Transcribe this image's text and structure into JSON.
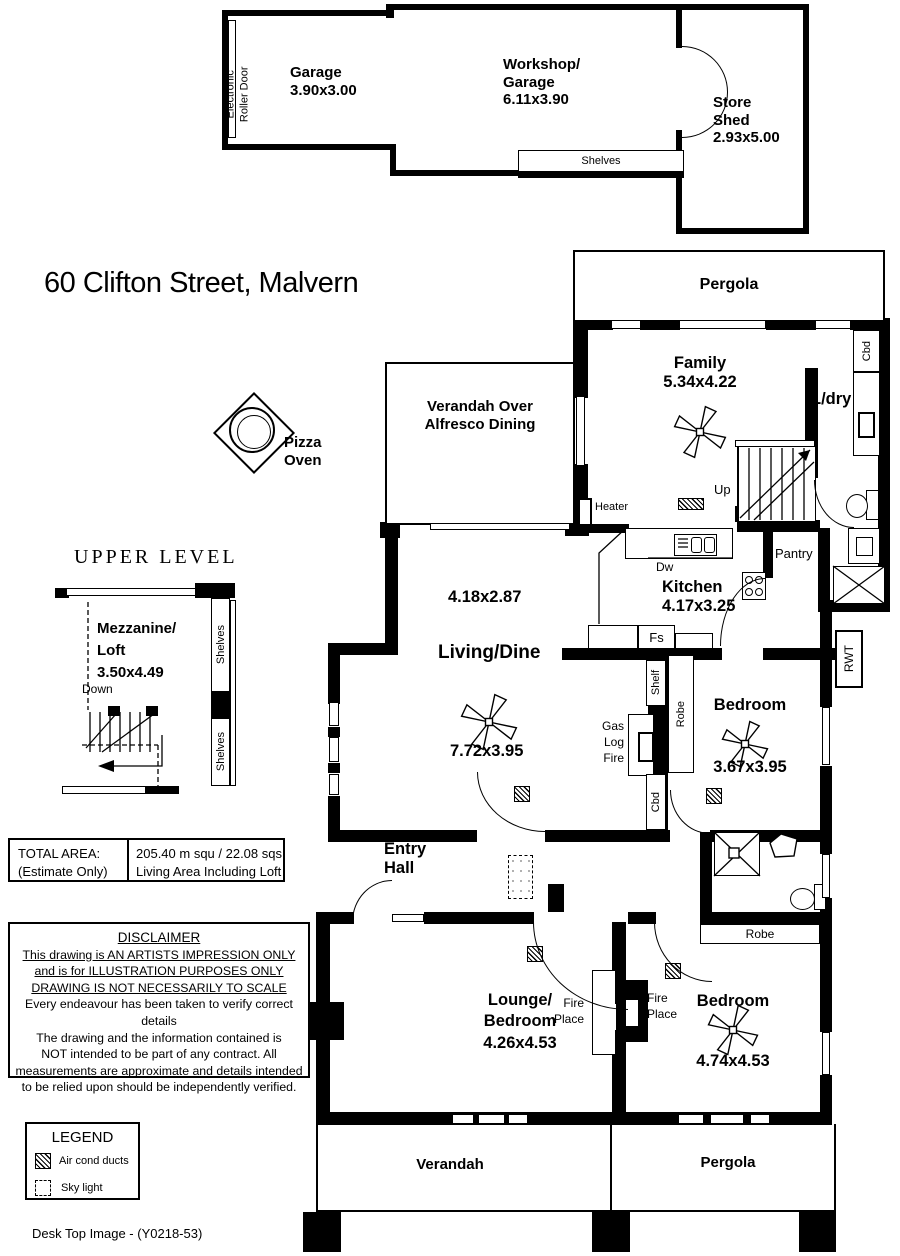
{
  "title": "60 Clifton Street, Malvern",
  "footer": "Desk Top Image - (Y0218-53)",
  "outbuilding": {
    "roller_1": "Electronic",
    "roller_2": "Roller Door",
    "garage_name": "Garage",
    "garage_dims": "3.90x3.00",
    "workshop_1": "Workshop/",
    "workshop_2": "Garage",
    "workshop_dims": "6.11x3.90",
    "shelves": "Shelves",
    "shed_1": "Store",
    "shed_2": "Shed",
    "shed_dims": "2.93x5.00"
  },
  "pizza_oven": {
    "line_1": "Pizza",
    "line_2": "Oven"
  },
  "upper": {
    "title": "UPPER LEVEL",
    "mezz_1": "Mezzanine/",
    "mezz_2": "Loft",
    "mezz_dims": "3.50x4.49",
    "down": "Down",
    "shelves_a": "Shelves",
    "shelves_b": "Shelves"
  },
  "house": {
    "pergola_top": "Pergola",
    "family_name": "Family",
    "family_dims": "5.34x4.22",
    "ldry": "L/dry",
    "cbd_top": "Cbd",
    "alfresco_1": "Verandah Over",
    "alfresco_2": "Alfresco Dining",
    "heater": "Heater",
    "up": "Up",
    "kitchen_name": "Kitchen",
    "kitchen_dims": "4.17x3.25",
    "dw": "Dw",
    "fs": "Fs",
    "pantry": "Pantry",
    "rwt": "RWT",
    "nook_dims": "4.18x2.87",
    "living_name": "Living/Dine",
    "living_dims": "7.72x3.95",
    "gas_1": "Gas",
    "gas_2": "Log",
    "gas_3": "Fire",
    "shelf": "Shelf",
    "robe_1": "Robe",
    "cbd_mid": "Cbd",
    "bed1_name": "Bedroom",
    "bed1_dims": "3.67x3.95",
    "entry_1": "Entry",
    "entry_2": "Hall",
    "lounge_1": "Lounge/",
    "lounge_2": "Bedroom",
    "lounge_dims": "4.26x4.53",
    "fire_a": "Fire",
    "fire_b": "Place",
    "bed2_name": "Bedroom",
    "bed2_dims": "4.74x4.53",
    "robe_2": "Robe",
    "verandah_bottom": "Verandah",
    "pergola_bottom": "Pergola"
  },
  "total_area": {
    "label_1": "TOTAL AREA:",
    "label_2": "(Estimate Only)",
    "value_1": "205.40 m squ /  22.08 sqs",
    "value_2": "Living Area Including Loft"
  },
  "disclaimer": {
    "title": "DISCLAIMER",
    "underlined": [
      "This drawing is AN ARTISTS IMPRESSION ONLY",
      "and is for ILLUSTRATION PURPOSES ONLY",
      "DRAWING IS NOT NECESSARILY TO SCALE"
    ],
    "lines": [
      "Every endeavour has been taken to verify correct details",
      "The drawing and the information contained is",
      "NOT intended to be part of any contract. All",
      "measurements are approximate and details intended",
      "to be relied upon should be independently verified."
    ]
  },
  "legend": {
    "title": "LEGEND",
    "item_1": "Air cond ducts",
    "item_2": "Sky light"
  }
}
